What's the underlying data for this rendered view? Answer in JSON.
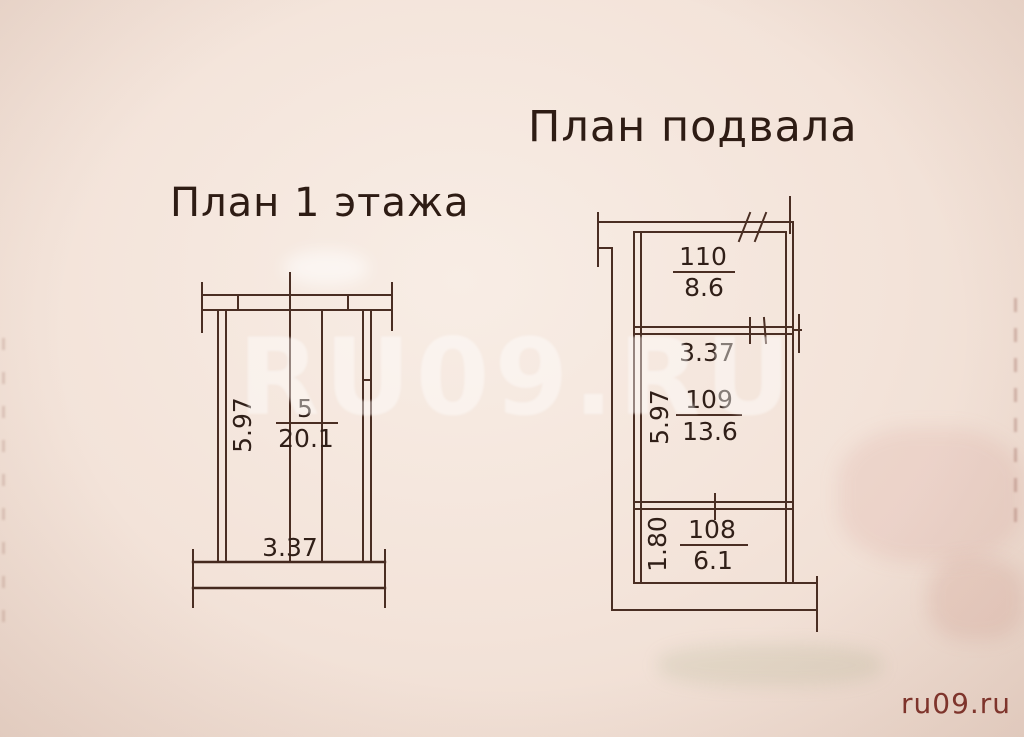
{
  "titles": {
    "floor1": "План 1 этажа",
    "basement": "План подвала"
  },
  "floor1": {
    "room": {
      "number": "5",
      "area": "20.1"
    },
    "dim_height": "5.97",
    "dim_width": "3.37"
  },
  "basement": {
    "rooms": [
      {
        "number": "110",
        "area": "8.6"
      },
      {
        "number": "109",
        "area": "13.6"
      },
      {
        "number": "108",
        "area": "6.1"
      }
    ],
    "dim_room109_width": "3.37",
    "dim_room109_height": "5.97",
    "dim_room108_height": "1.80"
  },
  "watermarks": {
    "center": "RU09.RU",
    "corner": "ru09.ru"
  },
  "colors": {
    "paper": "#f3e3d9",
    "ink": "#4a2e23",
    "title_ink": "#2e1c14",
    "watermark_white_opacity": "0.42",
    "watermark_red": "#7f332b"
  }
}
